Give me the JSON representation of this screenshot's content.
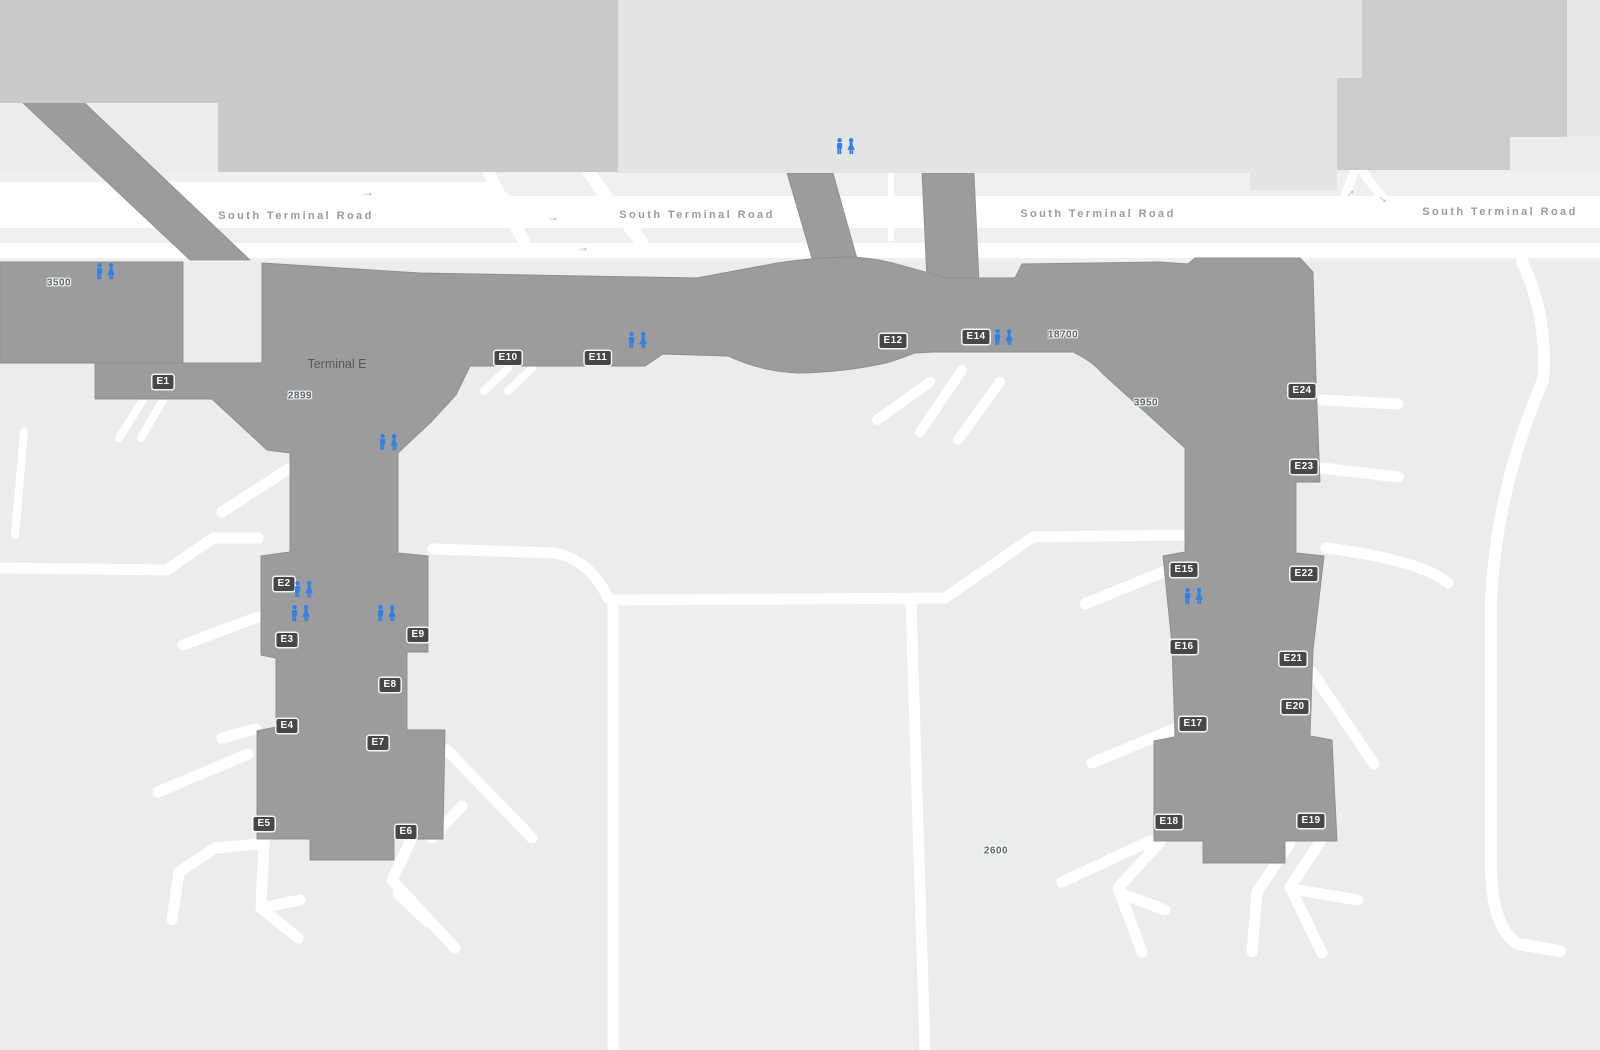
{
  "map": {
    "terminal_label": "Terminal E",
    "terminal_label_pos": {
      "x": 337,
      "y": 364
    },
    "road_name": "South Terminal Road",
    "road_labels": [
      {
        "x": 296,
        "y": 216
      },
      {
        "x": 697,
        "y": 215
      },
      {
        "x": 1098,
        "y": 214
      },
      {
        "x": 1500,
        "y": 212
      }
    ],
    "gates": [
      {
        "id": "E1",
        "x": 163,
        "y": 382
      },
      {
        "id": "E2",
        "x": 284,
        "y": 584
      },
      {
        "id": "E3",
        "x": 287,
        "y": 640
      },
      {
        "id": "E4",
        "x": 287,
        "y": 726
      },
      {
        "id": "E5",
        "x": 264,
        "y": 824
      },
      {
        "id": "E6",
        "x": 406,
        "y": 832
      },
      {
        "id": "E7",
        "x": 378,
        "y": 743
      },
      {
        "id": "E8",
        "x": 390,
        "y": 685
      },
      {
        "id": "E9",
        "x": 418,
        "y": 635
      },
      {
        "id": "E10",
        "x": 508,
        "y": 358
      },
      {
        "id": "E11",
        "x": 598,
        "y": 358
      },
      {
        "id": "E12",
        "x": 893,
        "y": 341
      },
      {
        "id": "E14",
        "x": 976,
        "y": 337
      },
      {
        "id": "E15",
        "x": 1184,
        "y": 570
      },
      {
        "id": "E16",
        "x": 1184,
        "y": 647
      },
      {
        "id": "E17",
        "x": 1193,
        "y": 724
      },
      {
        "id": "E18",
        "x": 1169,
        "y": 822
      },
      {
        "id": "E19",
        "x": 1311,
        "y": 821
      },
      {
        "id": "E20",
        "x": 1295,
        "y": 707
      },
      {
        "id": "E21",
        "x": 1293,
        "y": 659
      },
      {
        "id": "E22",
        "x": 1304,
        "y": 574
      },
      {
        "id": "E23",
        "x": 1304,
        "y": 467
      },
      {
        "id": "E24",
        "x": 1302,
        "y": 391
      }
    ],
    "numbers": [
      {
        "text": "3500",
        "x": 59,
        "y": 283
      },
      {
        "text": "2899",
        "x": 300,
        "y": 396
      },
      {
        "text": "18700",
        "x": 1063,
        "y": 335
      },
      {
        "text": "3950",
        "x": 1146,
        "y": 403
      },
      {
        "text": "2600",
        "x": 996,
        "y": 851
      }
    ],
    "restrooms": [
      {
        "x": 106,
        "y": 272
      },
      {
        "x": 846,
        "y": 147
      },
      {
        "x": 638,
        "y": 341
      },
      {
        "x": 389,
        "y": 443
      },
      {
        "x": 304,
        "y": 590
      },
      {
        "x": 301,
        "y": 614
      },
      {
        "x": 387,
        "y": 614
      },
      {
        "x": 1004,
        "y": 338
      },
      {
        "x": 1194,
        "y": 597
      }
    ],
    "arrows": [
      {
        "x": 368,
        "y": 192,
        "rot": 0
      },
      {
        "x": 553,
        "y": 217,
        "rot": 0
      },
      {
        "x": 583,
        "y": 247,
        "rot": 0
      },
      {
        "x": 1349,
        "y": 192,
        "rot": -40
      },
      {
        "x": 1384,
        "y": 198,
        "rot": 40
      }
    ],
    "arrow_glyph": "→",
    "colors": {
      "apron_background": "#ebecec",
      "terminal_gray": "#9c9c9c",
      "terminal_outline": "#8d8d8d",
      "garage_light": "#e3e4e4",
      "block_medium": "#c9cacb",
      "block_medium2": "#cbcccc",
      "road_white": "#ffffff",
      "road_median": "#eff0f0",
      "gate_badge_bg": "#474747",
      "gate_badge_text": "#ffffff",
      "road_label_text": "#979c9e",
      "number_text": "#5d6468",
      "restroom_blue": "#2f80e8",
      "terminal_label_text": "#575757"
    }
  }
}
